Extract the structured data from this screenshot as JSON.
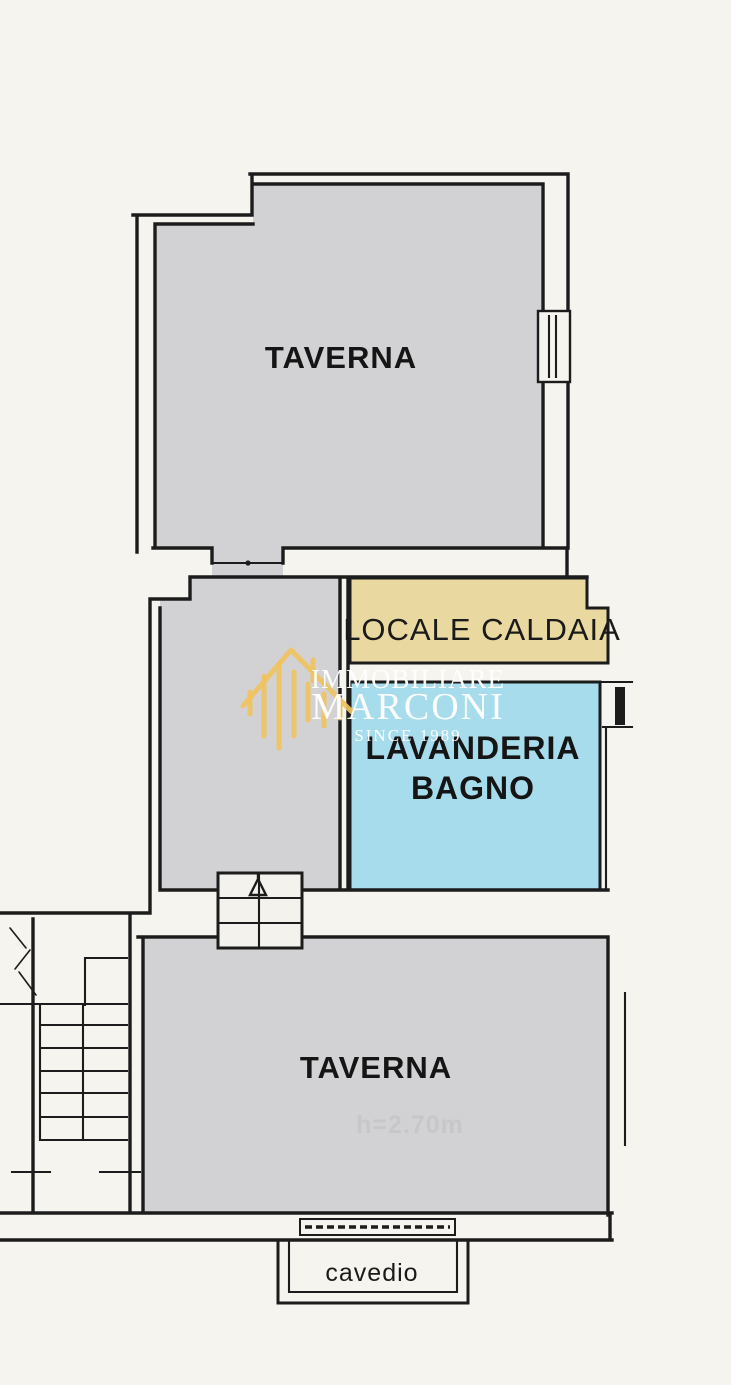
{
  "plan": {
    "rooms": {
      "taverna_upper": "TAVERNA",
      "locale_caldaia": "LOCALE CALDAIA",
      "lavanderia_line1": "LAVANDERIA",
      "lavanderia_line2": "BAGNO",
      "taverna_lower": "TAVERNA",
      "cavedio": "cavedio",
      "ghost_note": "h=2.70m"
    },
    "watermark": {
      "brand_line1": "IMMOBILIARE",
      "brand_line2": "MARCONI",
      "tagline": "SINCE 1989"
    },
    "colors": {
      "background": "#f5f4ee",
      "room_gray": "#d2d2d4",
      "caldaia_tan": "#e9d8a0",
      "lavanderia_blue": "#a6dcec",
      "wall": "#1c1c1c",
      "stair_fill": "#f3f2ed",
      "watermark_gold": "#f0c25e",
      "watermark_text": "#ffffff"
    }
  }
}
